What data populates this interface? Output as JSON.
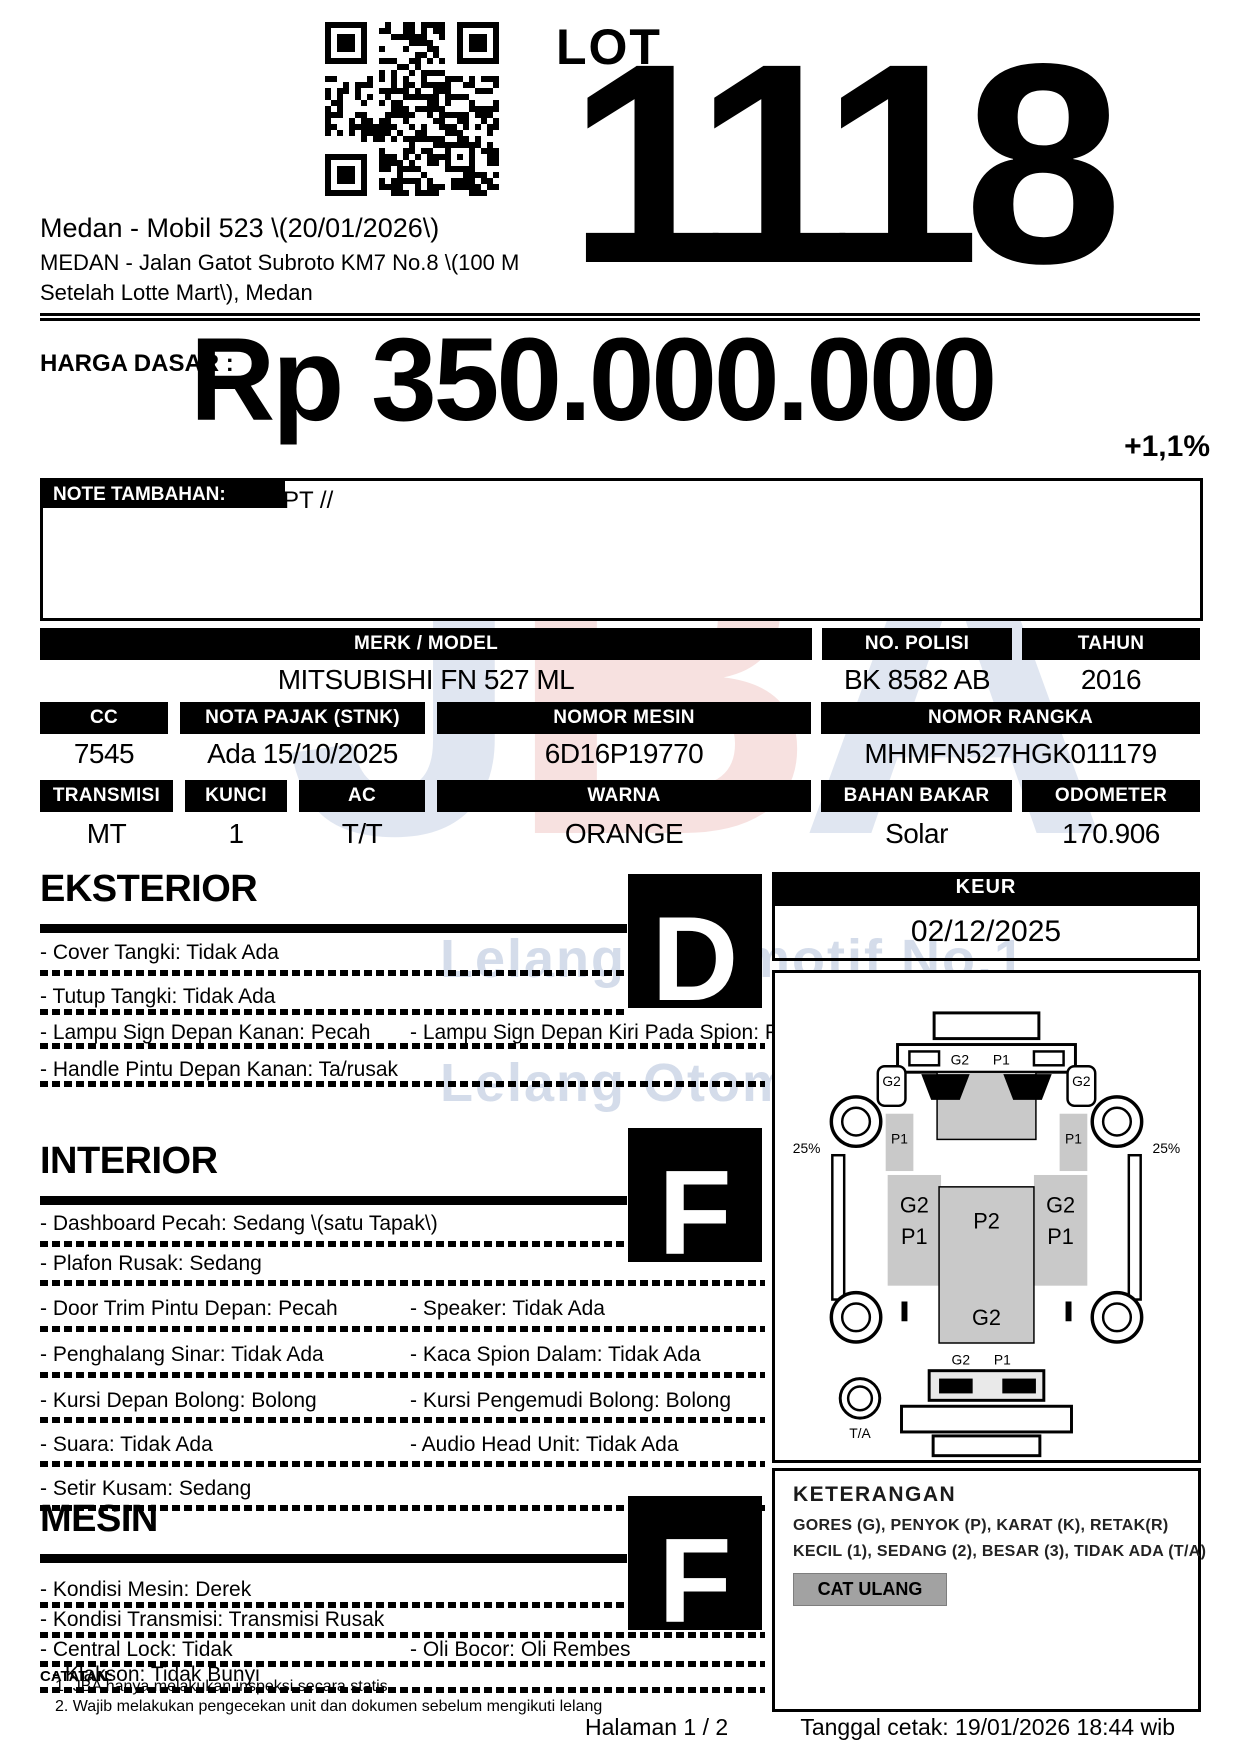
{
  "header": {
    "lot_label": "LOT",
    "lot_number": "1118",
    "title": "Medan - Mobil 523 \\(20/01/2026\\)",
    "address1": "MEDAN - Jalan Gatot Subroto KM7 No.8 \\(100 M",
    "address2": "Setelah Lotte Mart\\), Medan"
  },
  "price": {
    "label": "HARGA DASAR :",
    "amount": "Rp 350.000.000",
    "change": "+1,1%"
  },
  "note": {
    "label": "NOTE TAMBAHAN:",
    "text": "AN PT //"
  },
  "specs": {
    "merk": {
      "label": "MERK / MODEL",
      "value": "MITSUBISHI FN 527 ML"
    },
    "polisi": {
      "label": "NO. POLISI",
      "value": "BK 8582 AB"
    },
    "tahun": {
      "label": "TAHUN",
      "value": "2016"
    },
    "cc": {
      "label": "CC",
      "value": "7545"
    },
    "pajak": {
      "label": "NOTA PAJAK (STNK)",
      "value": "Ada 15/10/2025"
    },
    "mesin": {
      "label": "NOMOR MESIN",
      "value": "6D16P19770"
    },
    "rangka": {
      "label": "NOMOR RANGKA",
      "value": "MHMFN527HGK011179"
    },
    "transmisi": {
      "label": "TRANSMISI",
      "value": "MT"
    },
    "kunci": {
      "label": "KUNCI",
      "value": "1"
    },
    "ac": {
      "label": "AC",
      "value": "T/T"
    },
    "warna": {
      "label": "WARNA",
      "value": "ORANGE"
    },
    "bahan": {
      "label": "BAHAN BAKAR",
      "value": "Solar"
    },
    "odometer": {
      "label": "ODOMETER",
      "value": "170.906"
    }
  },
  "keur": {
    "label": "KEUR",
    "date": "02/12/2025"
  },
  "sections": {
    "eksterior": {
      "title": "EKSTERIOR",
      "grade": "D",
      "items": [
        {
          "col1": "- Cover Tangki: Tidak Ada"
        },
        {
          "col1": "- Tutup Tangki: Tidak Ada"
        },
        {
          "col1": "- Lampu Sign Depan Kanan: Pecah",
          "col2": "- Lampu Sign Depan Kiri Pada Spion: Pecah"
        },
        {
          "col1": "- Handle Pintu Depan Kanan: Ta/rusak"
        }
      ]
    },
    "interior": {
      "title": "INTERIOR",
      "grade": "F",
      "items": [
        {
          "col1": "- Dashboard Pecah: Sedang \\(satu Tapak\\)"
        },
        {
          "col1": "- Plafon Rusak: Sedang"
        },
        {
          "col1": "- Door Trim Pintu Depan: Pecah",
          "col2": "- Speaker: Tidak Ada"
        },
        {
          "col1": "- Penghalang Sinar: Tidak Ada",
          "col2": "- Kaca Spion Dalam: Tidak Ada"
        },
        {
          "col1": "- Kursi Depan Bolong: Bolong",
          "col2": "- Kursi Pengemudi Bolong: Bolong"
        },
        {
          "col1": "- Suara: Tidak Ada",
          "col2": "- Audio Head Unit: Tidak Ada"
        },
        {
          "col1": "- Setir Kusam: Sedang"
        }
      ]
    },
    "mesin": {
      "title": "MESIN",
      "grade": "F",
      "items": [
        {
          "col1": "- Kondisi Mesin: Derek"
        },
        {
          "col1": "- Kondisi Transmisi: Transmisi Rusak"
        },
        {
          "col1": "- Central Lock: Tidak",
          "col2": "- Oli Bocor: Oli Rembes"
        },
        {
          "col1": "- Klakson: Tidak Bunyi"
        }
      ]
    }
  },
  "diagram": {
    "labels": {
      "g2": "G2",
      "p1": "P1",
      "p2": "P2",
      "pct": "25%",
      "ta": "T/A"
    }
  },
  "keterangan": {
    "title": "KETERANGAN",
    "line1": "GORES (G), PENYOK (P), KARAT (K), RETAK(R)",
    "line2": "KECIL (1), SEDANG (2), BESAR (3), TIDAK ADA (T/A)",
    "button": "CAT ULANG"
  },
  "footer": {
    "catatan": "CATATAN:",
    "note1": "1. JBA hanya melakukan inspeksi secara statis",
    "note2": "2. Wajib melakukan pengecekan unit dan dokumen sebelum mengikuti lelang",
    "page": "Halaman 1 / 2",
    "printed": "Tanggal cetak: 19/01/2026 18:44 wib"
  },
  "watermark": {
    "logo_j": "J",
    "logo_b": "B",
    "logo_a": "A",
    "tagline1": "Lelang Otomotif No.1",
    "tagline2": "Lelang Otomotif No.1"
  },
  "colors": {
    "accent_black": "#000000",
    "diagram_gray": "#c9c9c9",
    "button_gray": "#a2a2a2",
    "watermark_blue": "#b9c6dd",
    "watermark_red": "#f0c5c2"
  }
}
